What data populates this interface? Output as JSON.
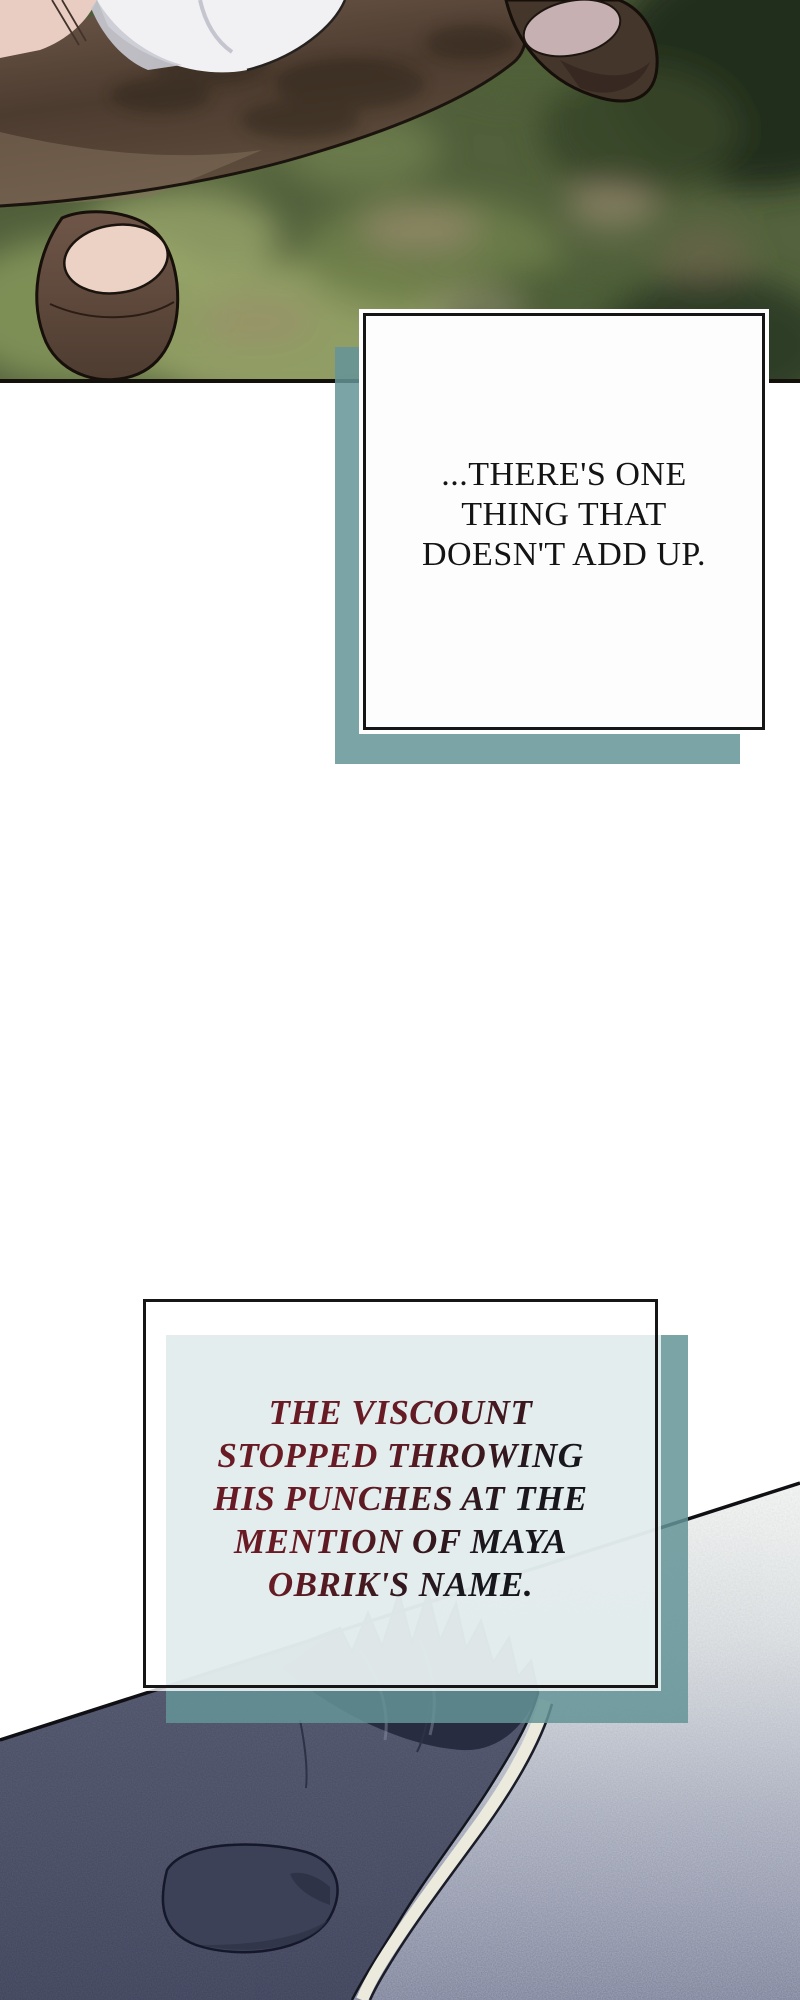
{
  "page": {
    "kind": "webtoon-comic-page",
    "width": 800,
    "height": 2000,
    "background": "#ffffff"
  },
  "colors": {
    "teal_shadow": "#649498",
    "panel_border": "#161616",
    "caption1_text": "#141414",
    "caption2_gradient_from": "#6a1b25",
    "caption2_gradient_to": "#141418",
    "figure_dark": "#4b5067",
    "hair_dark": "#272c40",
    "floor_light": "#f3f5f2",
    "floor_dark": "#80859d",
    "cloak_brown": "#4c3b2f",
    "foliage_green": "#55643e"
  },
  "captions": {
    "caption1": {
      "text": "...THERE'S ONE\nTHING THAT\nDOESN'T ADD UP."
    },
    "caption2": {
      "text": "THE VISCOUNT\nSTOPPED THROWING\nHIS PUNCHES AT THE\nMENTION OF MAYA\nOBRIK'S NAME."
    }
  },
  "artwork": {
    "top_panel": {
      "alt": "overhead view of character in brown cloak and boots on blurred grass"
    },
    "bottom_panel": {
      "alt": "dark-haired figure lying beside speckled stone floor"
    }
  }
}
